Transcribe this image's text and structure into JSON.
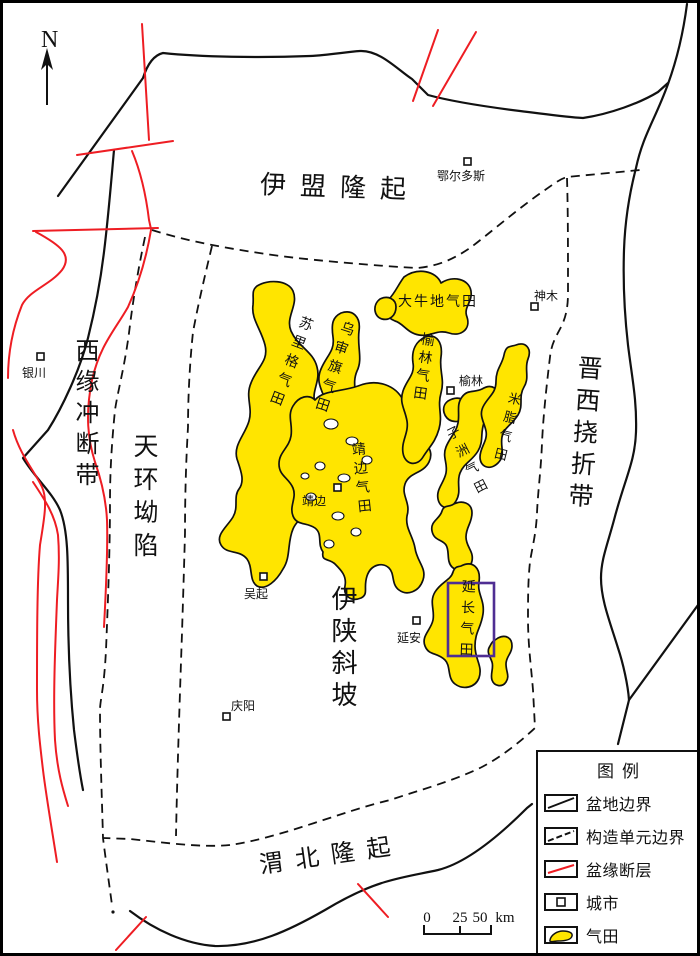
{
  "colors": {
    "gas_yellow": "#FFE500",
    "fault_red": "#EE1D23",
    "highlight_purple": "#4F2E93",
    "line_black": "#111111"
  },
  "compass": {
    "label": "N"
  },
  "tectonic_units": [
    {
      "name": "伊盟隆起"
    },
    {
      "name": "西缘冲断带"
    },
    {
      "name": "天环坳陷"
    },
    {
      "name": "晋西挠折带"
    },
    {
      "name": "伊陕斜坡"
    },
    {
      "name": "渭北隆起"
    }
  ],
  "cities": [
    {
      "name": "鄂尔多斯"
    },
    {
      "name": "神木"
    },
    {
      "name": "银川"
    },
    {
      "name": "榆林"
    },
    {
      "name": "靖边"
    },
    {
      "name": "吴起"
    },
    {
      "name": "延安"
    },
    {
      "name": "庆阳"
    }
  ],
  "gas_fields": [
    {
      "name": "大牛地气田"
    },
    {
      "name": "苏里格气田"
    },
    {
      "name": "乌审旗气田"
    },
    {
      "name": "榆林气田"
    },
    {
      "name": "靖边气田"
    },
    {
      "name": "子洲气田"
    },
    {
      "name": "米脂气田"
    },
    {
      "name": "延长气田"
    }
  ],
  "legend": {
    "title": "图例",
    "items": [
      {
        "label": "盆地边界",
        "symbol": "basin-boundary-line"
      },
      {
        "label": "构造单元边界",
        "symbol": "structural-unit-boundary-dashed"
      },
      {
        "label": "盆缘断层",
        "symbol": "basin-margin-fault-red-line"
      },
      {
        "label": "城市",
        "symbol": "city-square"
      },
      {
        "label": "气田",
        "symbol": "gas-field-patch"
      }
    ]
  },
  "scale_bar": {
    "ticks": [
      "0",
      "25",
      "50"
    ],
    "unit": "km"
  }
}
